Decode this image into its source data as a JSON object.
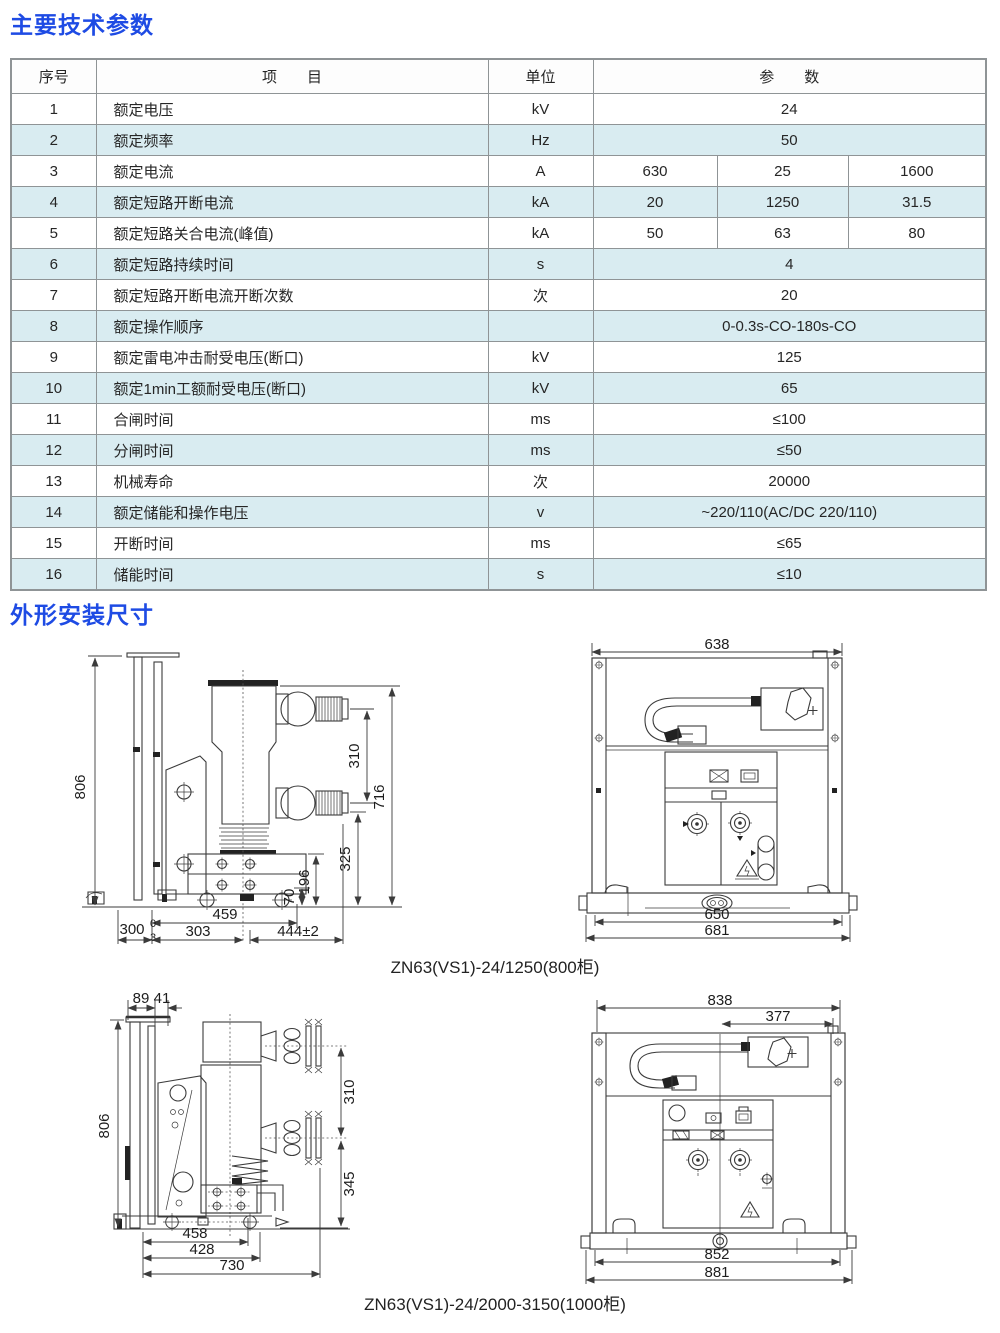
{
  "page": {
    "section1_title": "主要技术参数",
    "section2_title": "外形安装尺寸"
  },
  "colors": {
    "accent_blue": "#1e4be4",
    "table_alt_row": "#d9ecf1",
    "table_border": "#8f9496",
    "line_color": "#3b3b3b"
  },
  "table": {
    "headers": {
      "no": "序号",
      "item": "项　　目",
      "unit": "单位",
      "param": "参　　数"
    },
    "rows": [
      {
        "no": "1",
        "item": "额定电压",
        "unit": "kV",
        "p1": "24"
      },
      {
        "no": "2",
        "item": "额定频率",
        "unit": "Hz",
        "p1": "50"
      },
      {
        "no": "3",
        "item": "额定电流",
        "unit": "A",
        "p1": "630",
        "p2": "25",
        "p3": "1600"
      },
      {
        "no": "4",
        "item": "额定短路开断电流",
        "unit": "kA",
        "p1": "20",
        "p2": "1250",
        "p3": "31.5"
      },
      {
        "no": "5",
        "item": "额定短路关合电流(峰值)",
        "unit": "kA",
        "p1": "50",
        "p2": "63",
        "p3": "80"
      },
      {
        "no": "6",
        "item": "额定短路持续时间",
        "unit": "s",
        "p1": "4"
      },
      {
        "no": "7",
        "item": "额定短路开断电流开断次数",
        "unit": "次",
        "p1": "20"
      },
      {
        "no": "8",
        "item": "额定操作顺序",
        "unit": "",
        "p1": "0-0.3s-CO-180s-CO"
      },
      {
        "no": "9",
        "item": "额定雷电冲击耐受电压(断口)",
        "unit": "kV",
        "p1": "125"
      },
      {
        "no": "10",
        "item": "额定1min工额耐受电压(断口)",
        "unit": "kV",
        "p1": "65"
      },
      {
        "no": "11",
        "item": "合闸时间",
        "unit": "ms",
        "p1": "≤100"
      },
      {
        "no": "12",
        "item": "分闸时间",
        "unit": "ms",
        "p1": "≤50"
      },
      {
        "no": "13",
        "item": "机械寿命",
        "unit": "次",
        "p1": "20000"
      },
      {
        "no": "14",
        "item": "额定储能和操作电压",
        "unit": "v",
        "p1": "~220/110(AC/DC 220/110)"
      },
      {
        "no": "15",
        "item": "开断时间",
        "unit": "ms",
        "p1": "≤65"
      },
      {
        "no": "16",
        "item": "储能时间",
        "unit": "s",
        "p1": "≤10"
      }
    ]
  },
  "drawings": {
    "caption_800": "ZN63(VS1)-24/1250(800柜)",
    "caption_1000": "ZN63(VS1)-24/2000-3150(1000柜)",
    "side800": {
      "h806": "806",
      "v310": "310",
      "v716": "716",
      "v325": "325",
      "v196": "196",
      "v70": "70",
      "b300": "300",
      "tol_top": "0",
      "tol_bot": "3",
      "b459": "459",
      "b303": "303",
      "b444": "444±2"
    },
    "front800": {
      "t638": "638",
      "b650": "650",
      "b681": "681"
    },
    "side1000": {
      "t89": "89",
      "t41": "41",
      "h806": "806",
      "v310": "310",
      "v345": "345",
      "b458": "458",
      "b428": "428",
      "b730": "730"
    },
    "front1000": {
      "t838": "838",
      "t377": "377",
      "b852": "852",
      "b881": "881"
    }
  }
}
